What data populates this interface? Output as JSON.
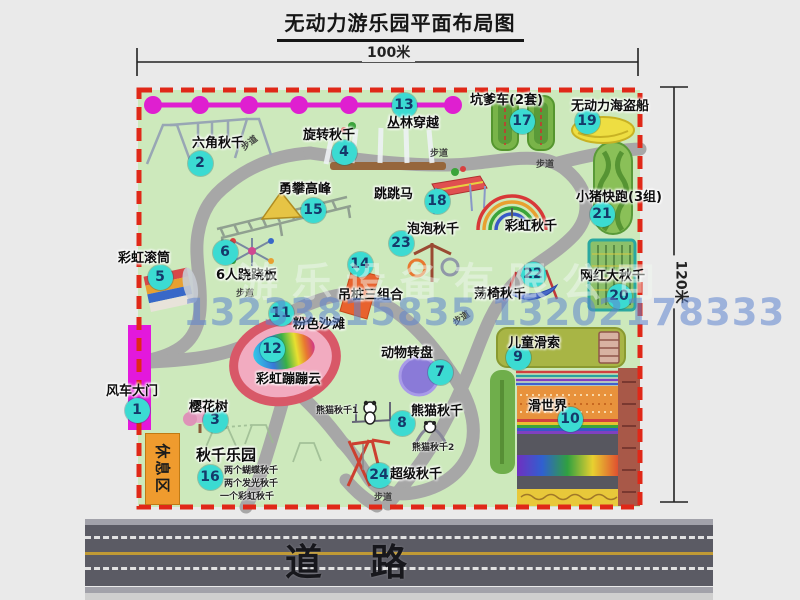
{
  "title": "无动力游乐园平面布局图",
  "dimensions": {
    "width_label": "100米",
    "height_label": "120米"
  },
  "road": {
    "label": "道路"
  },
  "rest_area_label": "休息区",
  "watermark": {
    "company": "游乐设备有限公司",
    "phone": "13233815835 13202178333"
  },
  "colors": {
    "park_green": "#cde9bc",
    "boundary_red": "#e02818",
    "path_gray": "#a7a7a7",
    "marker_teal": "#3bdbd2",
    "marker_text": "#15396a",
    "gate_magenta": "#e318dc",
    "rope_magenta": "#df1fd0",
    "rest_area_orange": "#ef9b2e",
    "road_gray": "#5b5b64",
    "lane_yellow": "#c09a35",
    "watermark_blue": "#5c84ce"
  },
  "map": {
    "markers": [
      {
        "num": "1",
        "name": "风车大门",
        "x": 137,
        "y": 410
      },
      {
        "num": "2",
        "name": "六角秋千",
        "x": 200,
        "y": 163
      },
      {
        "num": "3",
        "name": "樱花树",
        "x": 215,
        "y": 420
      },
      {
        "num": "4",
        "name": "旋转秋千",
        "x": 344,
        "y": 152
      },
      {
        "num": "5",
        "name": "彩虹滚筒",
        "x": 160,
        "y": 277
      },
      {
        "num": "6",
        "name": "6人跷跷板",
        "x": 225,
        "y": 252
      },
      {
        "num": "7",
        "name": "动物转盘",
        "x": 440,
        "y": 372
      },
      {
        "num": "8",
        "name": "熊猫秋千",
        "x": 402,
        "y": 423
      },
      {
        "num": "9",
        "name": "儿童滑索",
        "x": 518,
        "y": 357
      },
      {
        "num": "10",
        "name": "滑世界",
        "x": 570,
        "y": 419
      },
      {
        "num": "11",
        "name": "粉色沙滩",
        "x": 281,
        "y": 313
      },
      {
        "num": "12",
        "name": "彩虹蹦蹦云",
        "x": 272,
        "y": 349
      },
      {
        "num": "13",
        "name": "丛林穿越",
        "x": 404,
        "y": 105
      },
      {
        "num": "14",
        "name": "吊桩三组合",
        "x": 360,
        "y": 264
      },
      {
        "num": "15",
        "name": "勇攀高峰",
        "x": 313,
        "y": 210
      },
      {
        "num": "16",
        "name": "秋千乐园",
        "x": 210,
        "y": 477
      },
      {
        "num": "17",
        "name": "坑爹车(2套)",
        "x": 522,
        "y": 121
      },
      {
        "num": "18",
        "name": "跳跳马",
        "x": 437,
        "y": 201
      },
      {
        "num": "19",
        "name": "无动力海盗船",
        "x": 587,
        "y": 121
      },
      {
        "num": "20",
        "name": "网红大秋千",
        "x": 619,
        "y": 296
      },
      {
        "num": "21",
        "name": "小猪快跑(3组)",
        "x": 602,
        "y": 214
      },
      {
        "num": "22",
        "name": "荡椅秋千",
        "x": 533,
        "y": 274
      },
      {
        "num": "23",
        "name": "泡泡秋千",
        "x": 401,
        "y": 243
      },
      {
        "num": "24",
        "name": "超级秋千",
        "x": 379,
        "y": 475
      }
    ],
    "attraction_labels": [
      {
        "text": "风车大门",
        "x": 106,
        "y": 380
      },
      {
        "text": "六角秋千",
        "x": 192,
        "y": 132
      },
      {
        "text": "樱花树",
        "x": 189,
        "y": 396
      },
      {
        "text": "旋转秋千",
        "x": 303,
        "y": 124
      },
      {
        "text": "彩虹滚筒",
        "x": 118,
        "y": 247
      },
      {
        "text": "6人跷跷板",
        "x": 216,
        "y": 264
      },
      {
        "text": "勇攀高峰",
        "x": 279,
        "y": 178
      },
      {
        "text": "丛林穿越",
        "x": 387,
        "y": 112
      },
      {
        "text": "跳跳马",
        "x": 374,
        "y": 183
      },
      {
        "text": "坑爹车(2套)",
        "x": 470,
        "y": 89
      },
      {
        "text": "无动力海盗船",
        "x": 571,
        "y": 95
      },
      {
        "text": "小猪快跑(3组)",
        "x": 576,
        "y": 186
      },
      {
        "text": "彩虹秋千",
        "x": 505,
        "y": 215
      },
      {
        "text": "泡泡秋千",
        "x": 407,
        "y": 218
      },
      {
        "text": "吊桩三组合",
        "x": 338,
        "y": 284
      },
      {
        "text": "荡椅秋千",
        "x": 474,
        "y": 283
      },
      {
        "text": "网红大秋千",
        "x": 580,
        "y": 265
      },
      {
        "text": "粉色沙滩",
        "x": 293,
        "y": 313
      },
      {
        "text": "彩虹蹦蹦云",
        "x": 256,
        "y": 368
      },
      {
        "text": "动物转盘",
        "x": 381,
        "y": 342
      },
      {
        "text": "熊猫秋千",
        "x": 411,
        "y": 400
      },
      {
        "text": "儿童滑索",
        "x": 508,
        "y": 332
      },
      {
        "text": "滑世界",
        "x": 528,
        "y": 395
      },
      {
        "text": "超级秋千",
        "x": 390,
        "y": 463
      },
      {
        "text": "秋千乐园",
        "x": 196,
        "y": 444,
        "size": 15
      }
    ],
    "sub_labels": [
      {
        "text": "两个蝴蝶秋千",
        "x": 224,
        "y": 463
      },
      {
        "text": "两个发光秋千",
        "x": 224,
        "y": 476
      },
      {
        "text": "一个彩虹秋千",
        "x": 220,
        "y": 489
      },
      {
        "text": "熊猫秋千1",
        "x": 316,
        "y": 403
      },
      {
        "text": "熊猫秋千2",
        "x": 412,
        "y": 440
      }
    ],
    "walkway_labels": [
      {
        "text": "步道",
        "x": 240,
        "y": 136,
        "rot": -38
      },
      {
        "text": "步道",
        "x": 430,
        "y": 146,
        "rot": 0
      },
      {
        "text": "步道",
        "x": 536,
        "y": 157,
        "rot": 0
      },
      {
        "text": "步道",
        "x": 236,
        "y": 286,
        "rot": 0
      },
      {
        "text": "步道",
        "x": 452,
        "y": 311,
        "rot": -33
      },
      {
        "text": "步道",
        "x": 374,
        "y": 490,
        "rot": 0
      }
    ]
  }
}
